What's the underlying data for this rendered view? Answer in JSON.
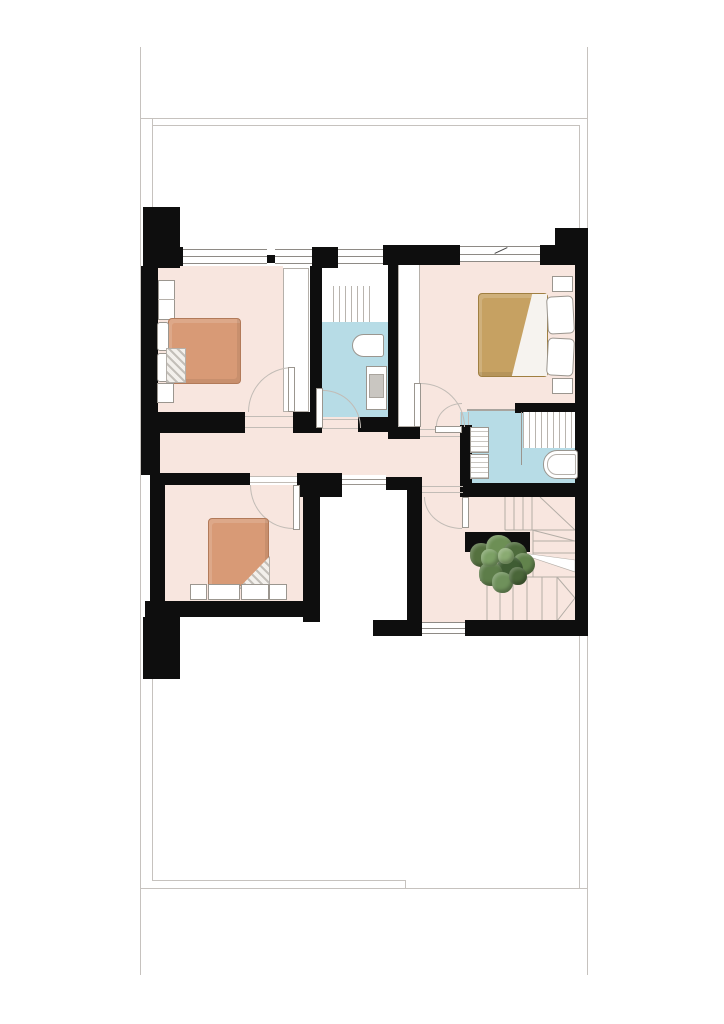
{
  "canvas": {
    "width": 724,
    "height": 1024
  },
  "palette": {
    "background": "#ffffff",
    "wall": "#0e0e0e",
    "outline": "#c6c2be",
    "floor_pink": "#f8e6df",
    "floor_blue": "#b7dce6",
    "fixture_border": "#9b968f",
    "threshold": "#c2bcb6",
    "duvet_salmon": "#d89a76",
    "duvet_salmon_border": "#b27a59",
    "duvet_tan": "#c6a162",
    "duvet_tan_border": "#a07f41",
    "pot": "#b2a89a",
    "tread_line": "#b3ada6"
  },
  "rooms": [
    {
      "name": "bedroom-top-left",
      "floor": "pink"
    },
    {
      "name": "bathroom-center",
      "floor": "blue"
    },
    {
      "name": "master-bedroom",
      "floor": "pink"
    },
    {
      "name": "bathroom-right",
      "floor": "blue"
    },
    {
      "name": "bedroom-bottom-left",
      "floor": "pink"
    },
    {
      "name": "hallway",
      "floor": "pink"
    },
    {
      "name": "stair-landing",
      "floor": "pink"
    },
    {
      "name": "stairwell",
      "floor": "pink"
    },
    {
      "name": "void-open-below",
      "floor": "white"
    }
  ],
  "fixtures": [
    "double-bed-salmon-left",
    "double-bed-salmon-bottom",
    "double-bed-tan-master",
    "wardrobe-strip-left",
    "wardrobe-strip-master",
    "closet",
    "nightstands",
    "washbasin",
    "toilet",
    "shower-center",
    "shower-right",
    "vanity-double-sink",
    "bathtub",
    "winder-staircase",
    "potted-plant",
    "windows",
    "door-swings",
    "void-railing"
  ],
  "plant": {
    "pot": {
      "x": 480,
      "y": 547,
      "w": 42,
      "h": 34
    },
    "blobs": [
      {
        "x": 470,
        "y": 543,
        "d": 24,
        "c": "#55713f"
      },
      {
        "x": 486,
        "y": 535,
        "d": 27,
        "c": "#6d8f55"
      },
      {
        "x": 503,
        "y": 542,
        "d": 24,
        "c": "#4e6b3c"
      },
      {
        "x": 513,
        "y": 553,
        "d": 22,
        "c": "#62834c"
      },
      {
        "x": 497,
        "y": 556,
        "d": 26,
        "c": "#3f5c33"
      },
      {
        "x": 479,
        "y": 562,
        "d": 24,
        "c": "#5d7d49"
      },
      {
        "x": 492,
        "y": 572,
        "d": 21,
        "c": "#6f915b"
      },
      {
        "x": 509,
        "y": 567,
        "d": 18,
        "c": "#4a6639"
      },
      {
        "x": 481,
        "y": 549,
        "d": 18,
        "c": "#7ca065"
      },
      {
        "x": 498,
        "y": 548,
        "d": 16,
        "c": "#8aab72"
      }
    ]
  }
}
